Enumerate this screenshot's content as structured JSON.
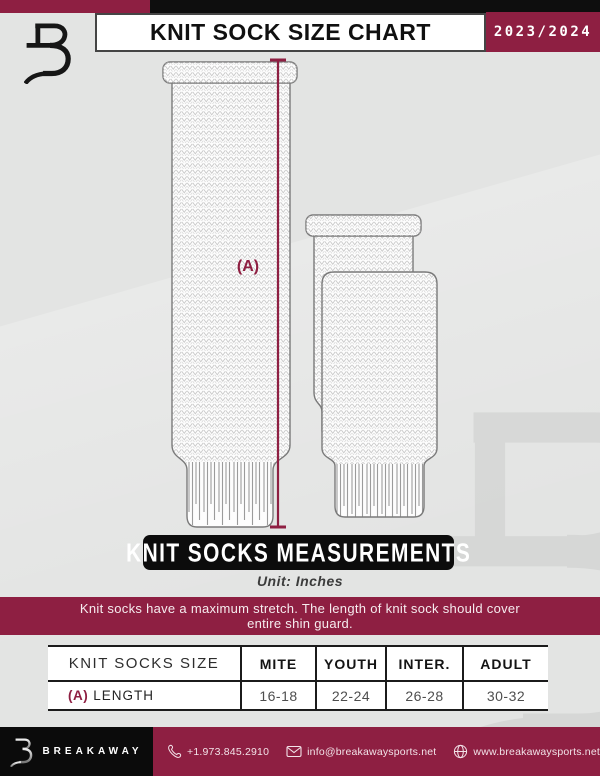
{
  "header": {
    "title": "KNIT SOCK SIZE CHART",
    "season": "2023/2024"
  },
  "illustration": {
    "measure_label": "(A)"
  },
  "measurements": {
    "banner": "KNIT SOCKS MEASUREMENTS",
    "unit": "Unit: Inches",
    "note": "Knit socks have a maximum stretch. The length of knit sock should cover entire shin guard."
  },
  "table": {
    "headers": [
      "KNIT SOCKS SIZE",
      "MITE",
      "YOUTH",
      "INTER.",
      "ADULT"
    ],
    "rows": [
      {
        "label_prefix": "(A)",
        "label": "LENGTH",
        "values": [
          "16-18",
          "22-24",
          "26-28",
          "30-32"
        ]
      }
    ]
  },
  "footer": {
    "brand": "BREAKAWAY",
    "phone": "+1.973.845.2910",
    "email": "info@breakawaysports.net",
    "website": "www.breakawaysports.net"
  },
  "colors": {
    "maroon": "#8E1F42",
    "black": "#0E0E0E",
    "background": "#E3E4E3"
  }
}
